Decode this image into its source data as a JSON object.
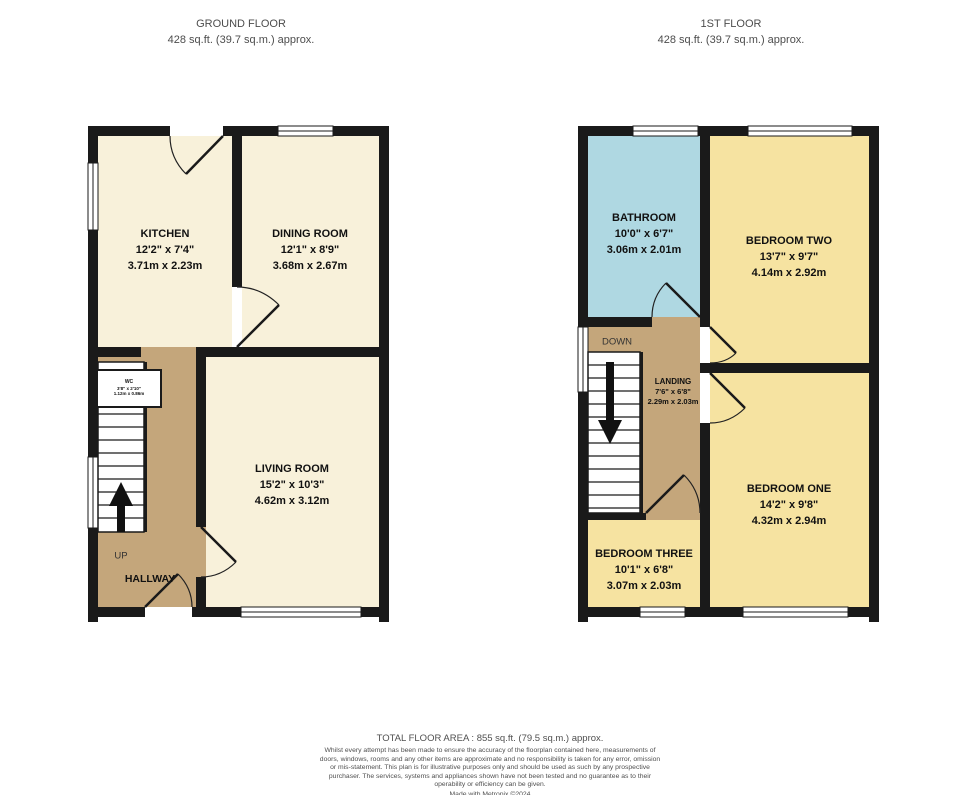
{
  "floors": {
    "ground": {
      "title": "GROUND FLOOR",
      "area": "428 sq.ft. (39.7 sq.m.) approx."
    },
    "first": {
      "title": "1ST FLOOR",
      "area": "428 sq.ft. (39.7 sq.m.) approx."
    }
  },
  "rooms": {
    "kitchen": {
      "name": "KITCHEN",
      "imperial": "12'2\" x 7'4\"",
      "metric": "3.71m x 2.23m"
    },
    "dining": {
      "name": "DINING ROOM",
      "imperial": "12'1\" x 8'9\"",
      "metric": "3.68m x 2.67m"
    },
    "living": {
      "name": "LIVING ROOM",
      "imperial": "15'2\" x 10'3\"",
      "metric": "4.62m x 3.12m"
    },
    "wc": {
      "name": "WC",
      "imperial": "3'8\" x 2'10\"",
      "metric": "1.12m x 0.86m"
    },
    "hallway": {
      "name": "HALLWAY"
    },
    "bathroom": {
      "name": "BATHROOM",
      "imperial": "10'0\" x 6'7\"",
      "metric": "3.06m x 2.01m"
    },
    "bedroom_two": {
      "name": "BEDROOM TWO",
      "imperial": "13'7\" x 9'7\"",
      "metric": "4.14m x 2.92m"
    },
    "landing": {
      "name": "LANDING",
      "imperial": "7'6\" x 6'8\"",
      "metric": "2.29m x 2.03m"
    },
    "bedroom_one": {
      "name": "BEDROOM ONE",
      "imperial": "14'2\" x 9'8\"",
      "metric": "4.32m x 2.94m"
    },
    "bedroom_three": {
      "name": "BEDROOM THREE",
      "imperial": "10'1\" x 6'8\"",
      "metric": "3.07m x 2.03m"
    }
  },
  "stairs": {
    "up": "UP",
    "down": "DOWN"
  },
  "footer": {
    "total": "TOTAL FLOOR AREA : 855 sq.ft. (79.5 sq.m.) approx.",
    "disclaimer": "Whilst every attempt has been made to ensure the accuracy of the floorplan contained here, measurements of doors, windows, rooms and any other items are approximate and no responsibility is taken for any error, omission or mis-statement. This plan is for illustrative purposes only and should be used as such by any prospective purchaser. The services, systems and appliances shown have not been tested and no guarantee as to their operability or efficiency can be given.",
    "credit": "Made with Metropix ©2024"
  },
  "colors": {
    "room_cream": "#F8F1DA",
    "room_yellow": "#F6E3A1",
    "room_blue": "#AFD8E2",
    "hall_tan": "#C4A67B",
    "wall": "#1a1a1a"
  }
}
